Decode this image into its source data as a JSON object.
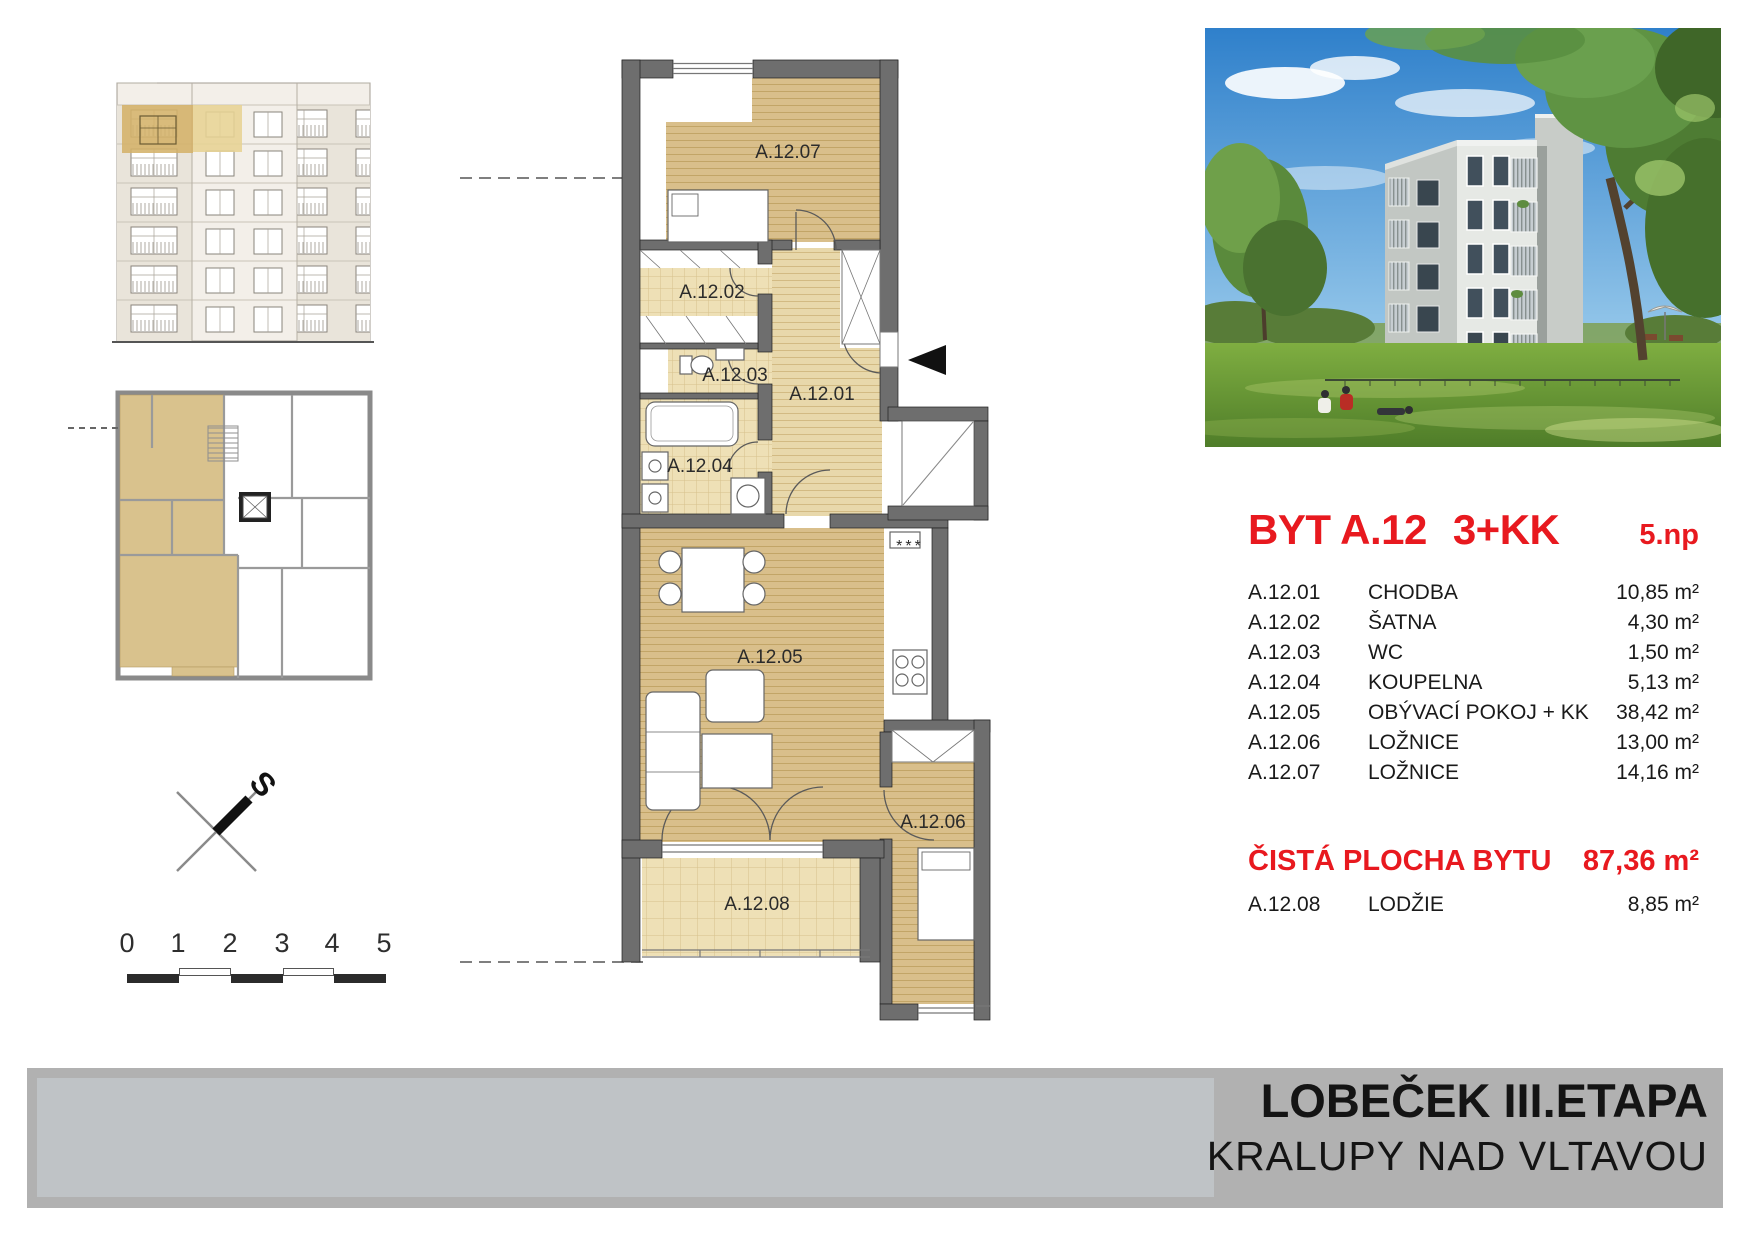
{
  "project": {
    "name": "LOBEČEK III.ETAPA",
    "city": "KRALUPY NAD VLTAVOU"
  },
  "unit": {
    "name": "BYT A.12",
    "layout": "3+KK",
    "floor": "5.np",
    "rooms": [
      {
        "code": "A.12.01",
        "name": "CHODBA",
        "area": "10,85 m²"
      },
      {
        "code": "A.12.02",
        "name": "ŠATNA",
        "area": "4,30 m²"
      },
      {
        "code": "A.12.03",
        "name": "WC",
        "area": "1,50 m²"
      },
      {
        "code": "A.12.04",
        "name": "KOUPELNA",
        "area": "5,13 m²"
      },
      {
        "code": "A.12.05",
        "name": "OBÝVACÍ POKOJ + KK",
        "area": "38,42 m²"
      },
      {
        "code": "A.12.06",
        "name": "LOŽNICE",
        "area": "13,00 m²"
      },
      {
        "code": "A.12.07",
        "name": "LOŽNICE",
        "area": "14,16 m²"
      }
    ],
    "total": {
      "label": "ČISTÁ PLOCHA BYTU",
      "area": "87,36 m²"
    },
    "loggia": {
      "code": "A.12.08",
      "name": "LODŽIE",
      "area": "8,85 m²"
    }
  },
  "plan_labels": {
    "r01": "A.12.01",
    "r02": "A.12.02",
    "r03": "A.12.03",
    "r04": "A.12.04",
    "r05": "A.12.05",
    "r06": "A.12.06",
    "r07": "A.12.07",
    "r08": "A.12.08",
    "kitchen_marker": "***"
  },
  "compass": {
    "north_label": "S"
  },
  "scale_bar": {
    "ticks": [
      "0",
      "1",
      "2",
      "3",
      "4",
      "5"
    ]
  },
  "colors": {
    "accent_red": "#e8191f",
    "wall_gray": "#6e6e6e",
    "wood_floor": "#d9bf8b",
    "tile_floor": "#eee0b6",
    "highlight_tan": "#d4b269",
    "footer_gray": "#b1b1b1",
    "footer_panel": "#bfc3c6"
  }
}
